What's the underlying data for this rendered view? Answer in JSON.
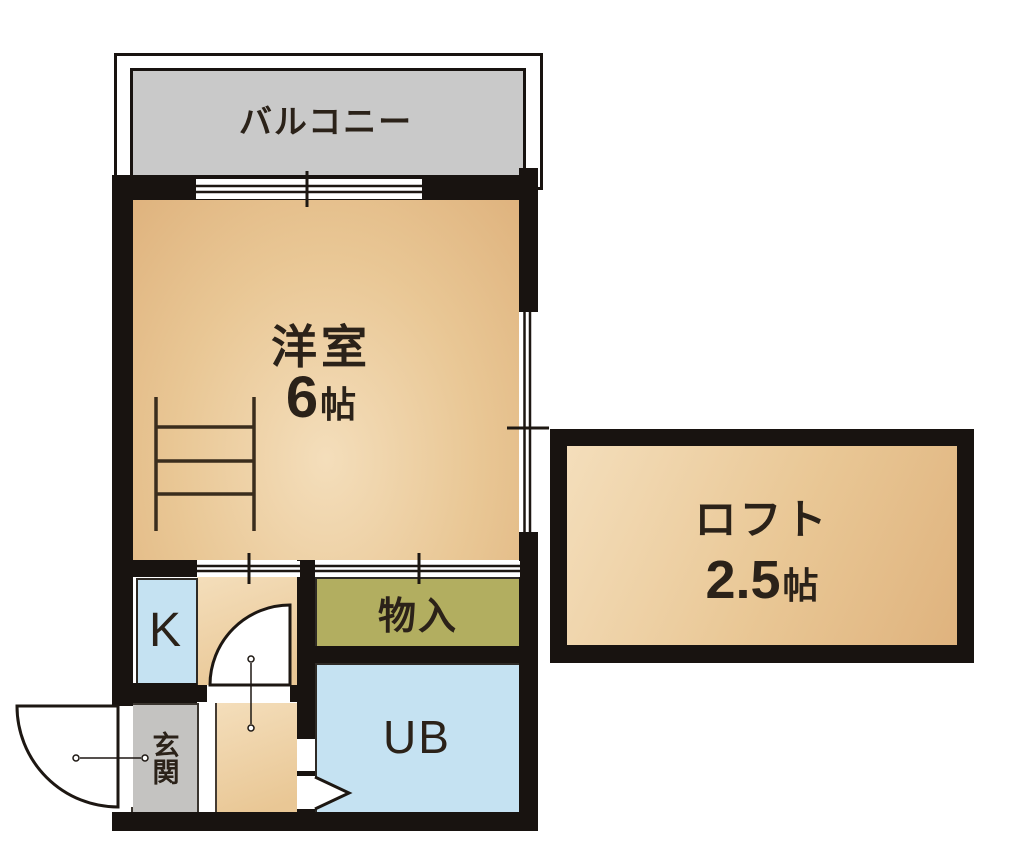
{
  "title": "apartment-floor-plan",
  "rooms": {
    "balcony": {
      "label": "バルコニー"
    },
    "western_room": {
      "label": "洋室",
      "size_value": "6",
      "size_unit": "帖"
    },
    "loft": {
      "label": "ロフト",
      "size_value": "2.5",
      "size_unit": "帖"
    },
    "kitchen": {
      "label": "K"
    },
    "storage": {
      "label": "物入"
    },
    "unit_bath": {
      "label": "UB"
    },
    "entrance": {
      "label": "玄関"
    }
  },
  "colors": {
    "wall": "#181310",
    "peach-light": "#f4debb",
    "peach": "#e9c795",
    "peach-dark": "#dfb37e",
    "balcony-gray": "#c9c9c9",
    "entrance-gray": "#c4c3c1",
    "water-blue": "#c5e2f2",
    "storage-olive": "#b2ae60",
    "text": "#2b2219",
    "line": "#1d1712"
  }
}
